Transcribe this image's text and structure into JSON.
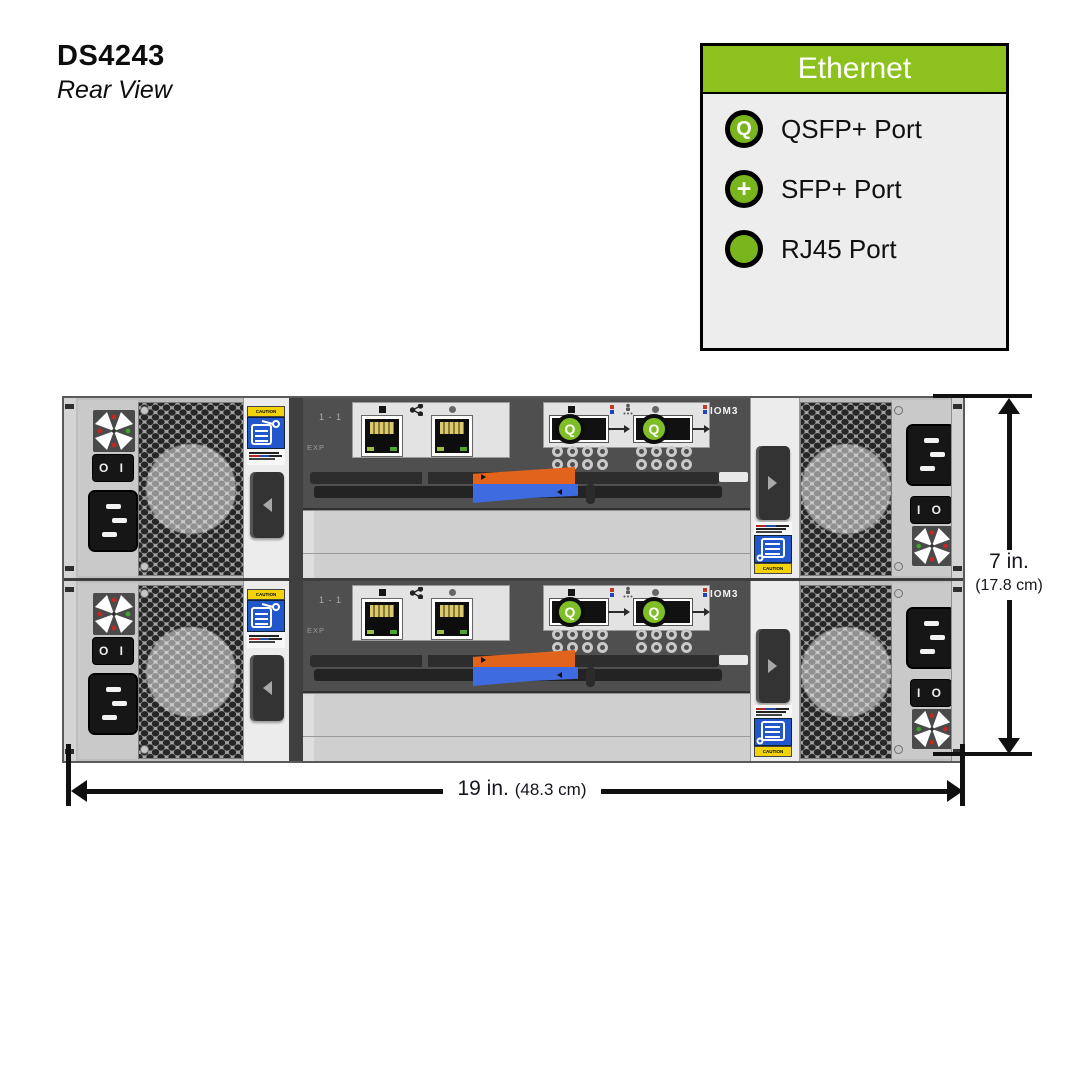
{
  "header": {
    "title": "DS4243",
    "subtitle": "Rear View"
  },
  "legend": {
    "title": "Ethernet",
    "items": [
      {
        "icon": "qsfp-port-icon",
        "symbol": "Q",
        "label": "QSFP+ Port"
      },
      {
        "icon": "sfp-port-icon",
        "symbol": "+",
        "label": "SFP+ Port"
      },
      {
        "icon": "rj45-port-icon",
        "symbol": "",
        "label": "RJ45 Port"
      }
    ]
  },
  "chassis": {
    "iom": {
      "model_label": "IOM3",
      "port_pair_label": "1 - 1",
      "exp_label": "EXP",
      "qsfp_symbol": "Q"
    },
    "psu": {
      "switch_left": "O I",
      "switch_right": "I O",
      "caution_text": "CAUTION"
    },
    "dimensions": {
      "height_primary": "7 in.",
      "height_secondary": "(17.8 cm)",
      "width_primary": "19 in.",
      "width_secondary": "(48.3 cm)"
    }
  },
  "colors": {
    "legend_green": "#8DC21E",
    "port_circle_green": "#7FBE26",
    "lever_orange": "#E2631B",
    "lever_blue": "#3E6BE0",
    "caution_yellow": "#F2D30A",
    "caution_blue": "#2257CC"
  }
}
